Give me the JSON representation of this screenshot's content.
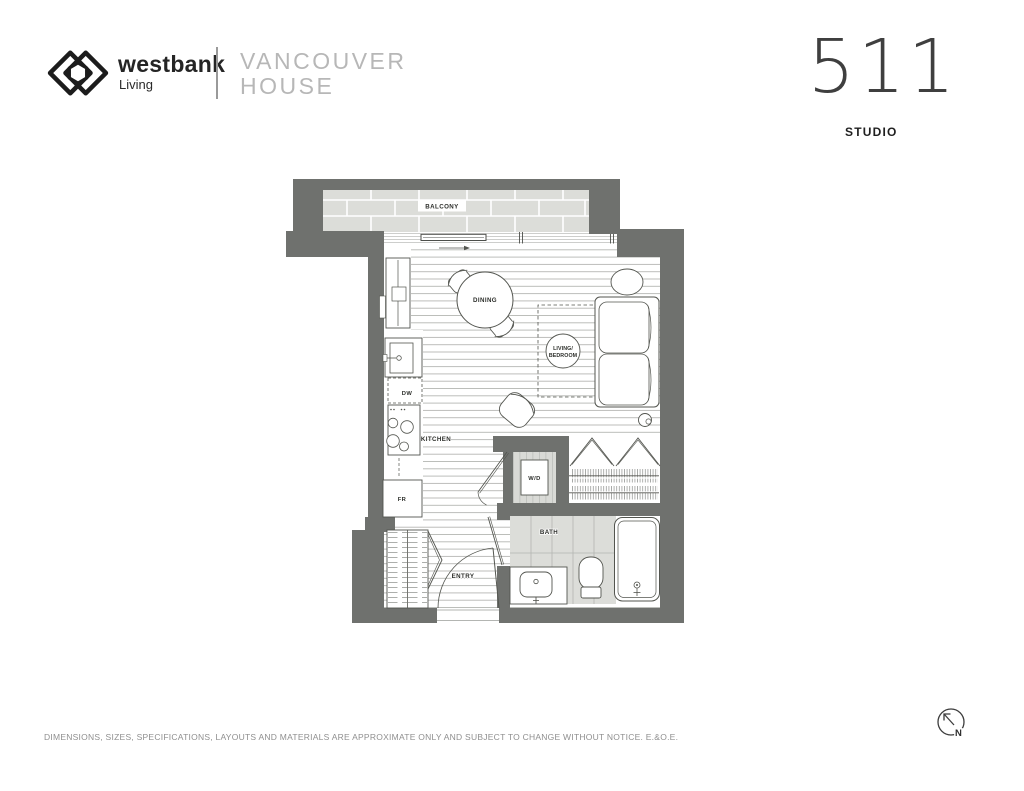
{
  "header": {
    "brand": {
      "name": "westbank",
      "sub": "Living"
    },
    "project": {
      "line1": "VANCOUVER",
      "line2": "HOUSE"
    },
    "unit": {
      "number": "511",
      "type": "STUDIO"
    }
  },
  "plan": {
    "rooms": {
      "balcony": "BALCONY",
      "dining": "DINING",
      "living_line1": "LIVING/",
      "living_line2": "BEDROOM",
      "kitchen": "KITCHEN",
      "dw": "DW",
      "fr": "FR",
      "wd": "W/D",
      "bath": "BATH",
      "entry": "ENTRY"
    }
  },
  "footer": {
    "disclaimer": "DIMENSIONS, SIZES, SPECIFICATIONS, LAYOUTS AND MATERIALS ARE APPROXIMATE ONLY AND SUBJECT TO CHANGE WITHOUT NOTICE. E.&O.E.",
    "north_label": "N"
  },
  "colors": {
    "wall": "#6f716e",
    "tile": "#dcddd9",
    "plank_line": "#b5b7b3",
    "line": "#53554f",
    "text_dark": "#2c2e2a",
    "text_light": "#b7b7b7"
  }
}
